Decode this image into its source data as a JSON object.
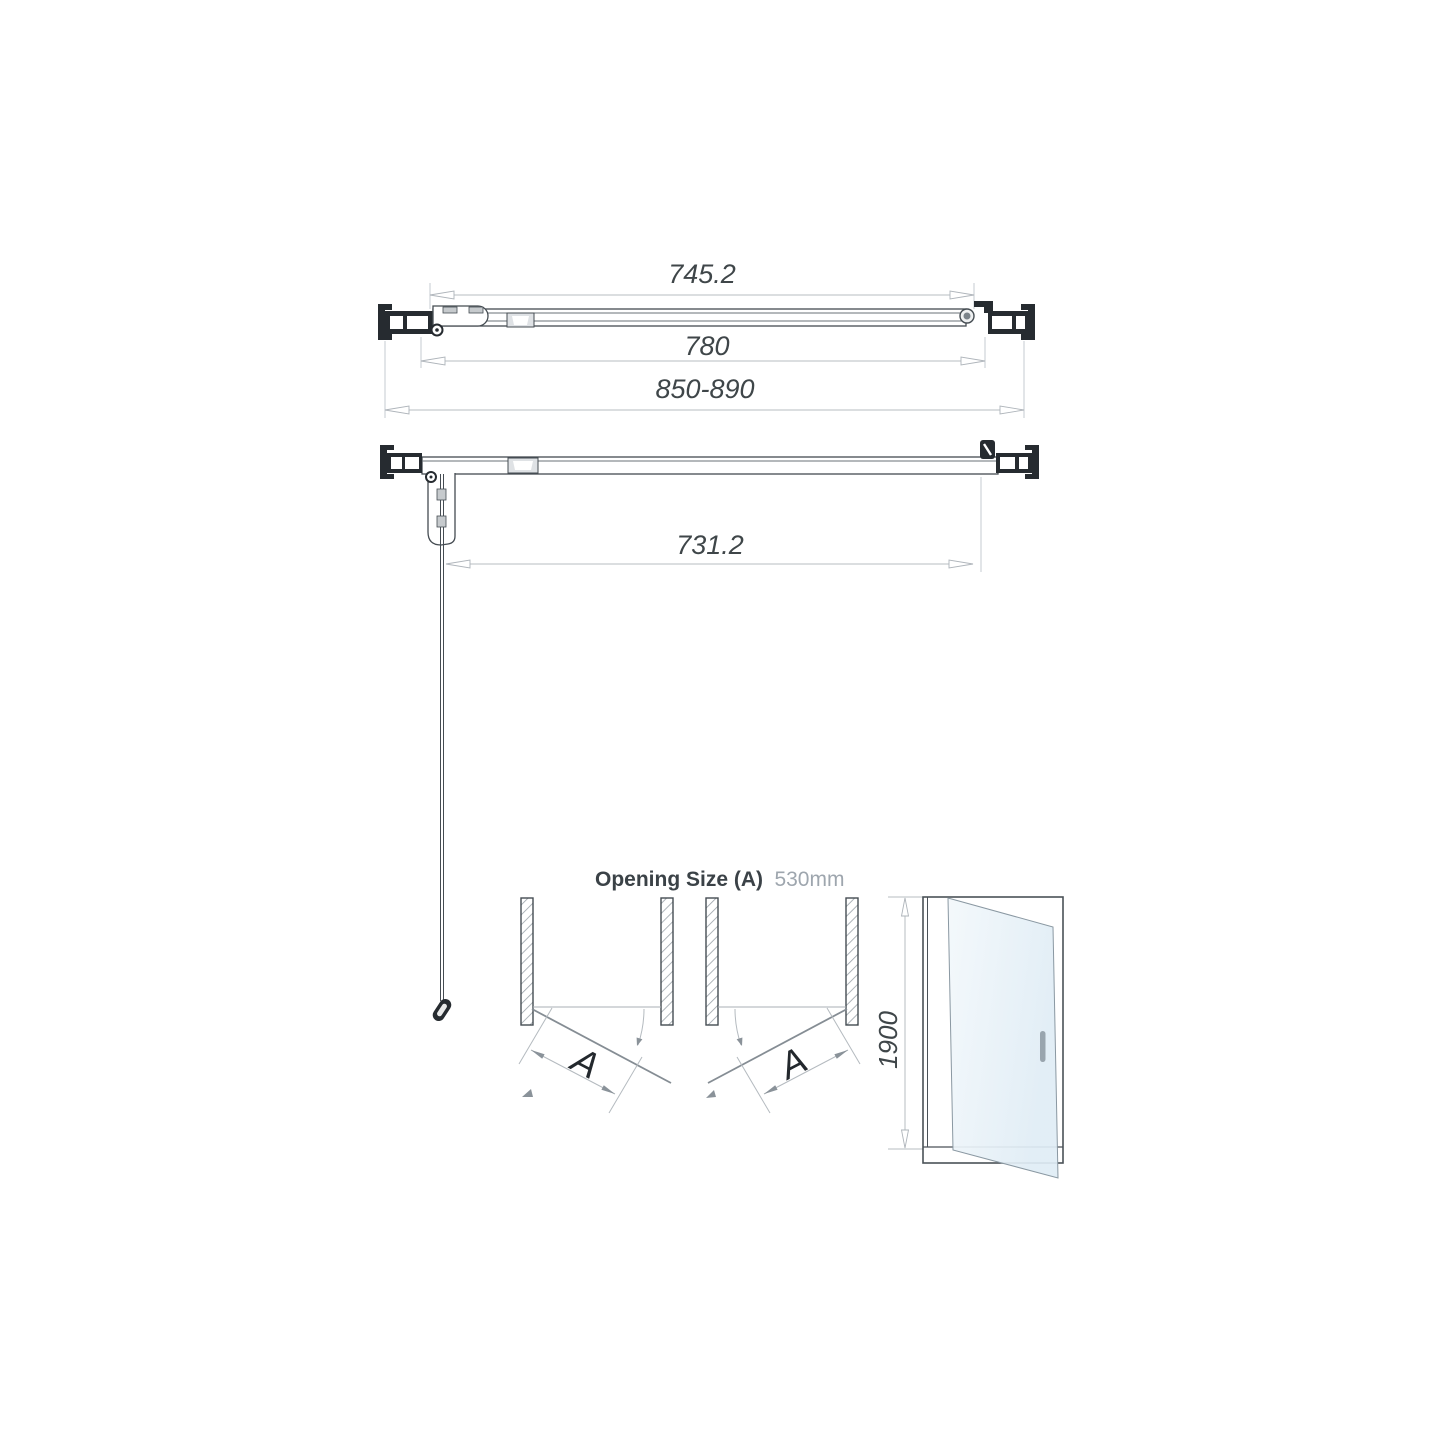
{
  "dimensions": {
    "top_view": {
      "glass_width": "745.2",
      "door_width": "780",
      "overall_range": "850-890"
    },
    "open_view": {
      "clearance": "731.2"
    },
    "opening": {
      "label": "Opening Size (A)",
      "value": "530mm"
    },
    "swing": {
      "label_left": "A",
      "label_right": "A"
    },
    "elevation": {
      "height": "1900"
    }
  },
  "colors": {
    "line_dark": "#454c52",
    "profile_fill": "#262b30",
    "dimension_line": "#b7bdc2",
    "dimension_text": "#3f4649",
    "muted_text": "#9ea6ae",
    "glass_tint": "#dfecf5"
  }
}
